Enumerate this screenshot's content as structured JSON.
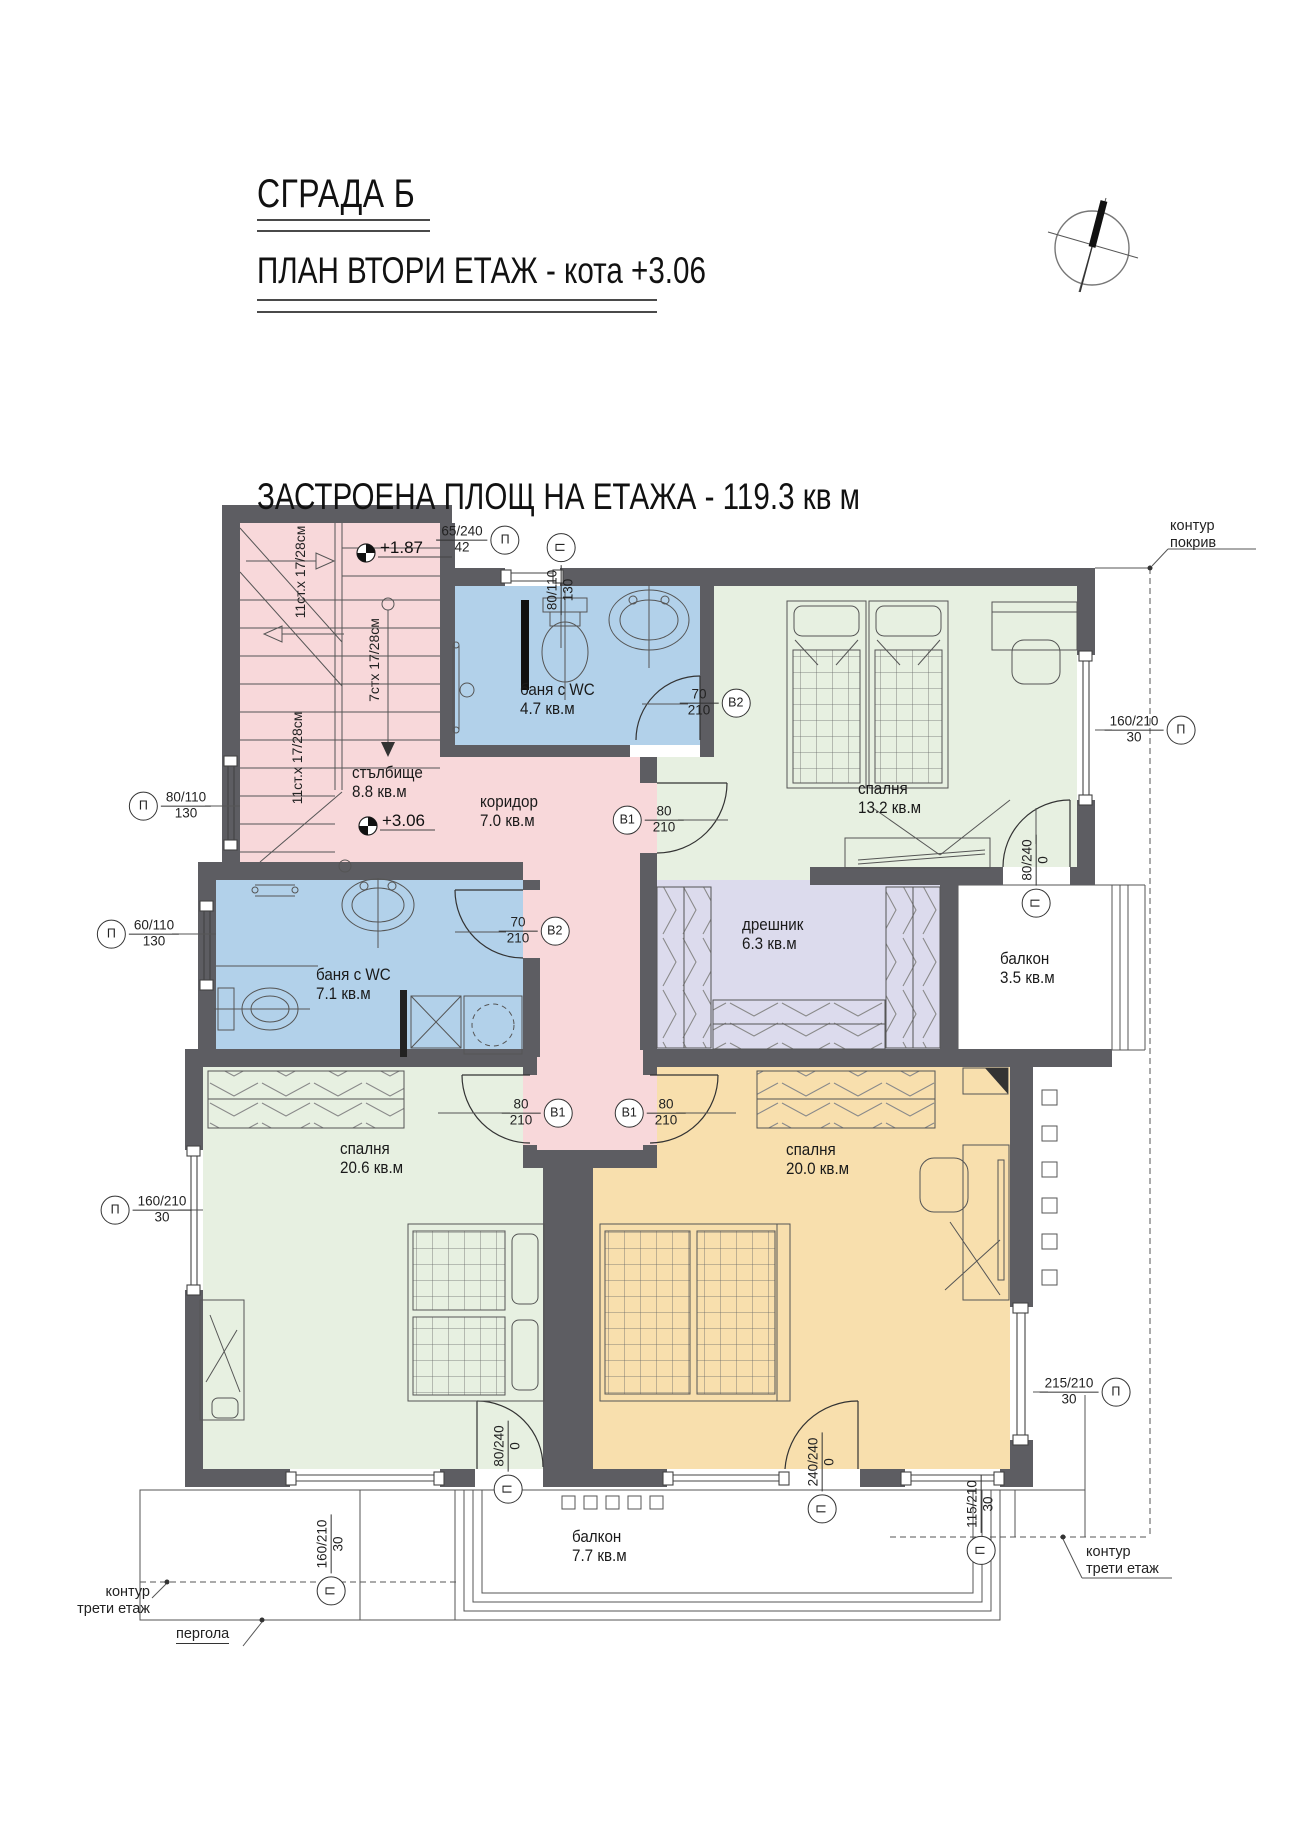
{
  "title": {
    "building": "СГРАДА Б",
    "plan_line": "ПЛАН ВТОРИ ЕТАЖ - кота +3.06",
    "area_line": "ЗАСТРОЕНА ПЛОЩ НА ЕТАЖА - 119.3 кв м"
  },
  "levels": {
    "upper": "+1.87",
    "lower": "+3.06"
  },
  "stair_notes": {
    "flight_a": "11ст.х 17/28см",
    "flight_b": "7стх 17/28см",
    "flight_c": "11ст.х 17/28см"
  },
  "rooms": {
    "staircase": {
      "name": "стълбище",
      "area": "8.8 кв.м"
    },
    "corridor": {
      "name": "коридор",
      "area": "7.0 кв.м"
    },
    "bath_small": {
      "name": "баня с WC",
      "area": "4.7 кв.м"
    },
    "bedroom_13": {
      "name": "спалня",
      "area": "13.2 кв.м"
    },
    "closet": {
      "name": "дрешник",
      "area": "6.3 кв.м"
    },
    "balcony_35": {
      "name": "балкон",
      "area": "3.5 кв.м"
    },
    "bath_large": {
      "name": "баня с WC",
      "area": "7.1 кв.м"
    },
    "bedroom_206": {
      "name": "спалня",
      "area": "20.6 кв.м"
    },
    "bedroom_200": {
      "name": "спалня",
      "area": "20.0 кв.м"
    },
    "balcony_77": {
      "name": "балкон",
      "area": "7.7 кв.м"
    }
  },
  "dimensions": {
    "top_door": {
      "value": "65/240",
      "sub": "42",
      "tag": "П"
    },
    "top_window": {
      "value": "80/110",
      "sub": "130",
      "tag": "П"
    },
    "left_window_stair": {
      "value": "80/110",
      "sub": "130",
      "tag": "П"
    },
    "left_window_bath": {
      "value": "60/110",
      "sub": "130",
      "tag": "П"
    },
    "left_window_bedroom": {
      "value": "160/210",
      "sub": "30",
      "tag": "П"
    },
    "right_window_bedroom13": {
      "value": "160/210",
      "sub": "30",
      "tag": "П"
    },
    "right_window_bedroom20": {
      "value": "215/210",
      "sub": "30",
      "tag": "П"
    },
    "balcony35_door": {
      "value": "80/240",
      "sub": "0",
      "tag": "П"
    },
    "bottom_window_left": {
      "value": "160/210",
      "sub": "30",
      "tag": "П"
    },
    "bottom_door_206": {
      "value": "80/240",
      "sub": "0",
      "tag": "П"
    },
    "bottom_door_200": {
      "value": "240/240",
      "sub": "0",
      "tag": "П"
    },
    "bottom_window_right": {
      "value": "115/210",
      "sub": "30",
      "tag": "П"
    },
    "door_bath_small": {
      "value": "70",
      "sub": "210",
      "tag": "B2"
    },
    "door_bath_large": {
      "value": "70",
      "sub": "210",
      "tag": "B2"
    },
    "door_bedroom13": {
      "value": "80",
      "sub": "210",
      "tag": "B1"
    },
    "door_bedroom206": {
      "value": "80",
      "sub": "210",
      "tag": "B1"
    },
    "door_bedroom200": {
      "value": "80",
      "sub": "210",
      "tag": "B1"
    }
  },
  "annotations": {
    "roof": {
      "line1": "контур",
      "line2": "покрив"
    },
    "third_floor_right": {
      "line1": "контур",
      "line2": "трети етаж"
    },
    "third_floor_left": {
      "line1": "контур",
      "line2": "трети етаж"
    },
    "pergola": "пергола"
  },
  "colors": {
    "wall": "#5d5d62",
    "stair": "#f8d8da",
    "bath": "#b2d1ea",
    "green": "#e7f0e1",
    "closet": "#dcdbed",
    "orange": "#f8dfad",
    "line": "#333333"
  }
}
